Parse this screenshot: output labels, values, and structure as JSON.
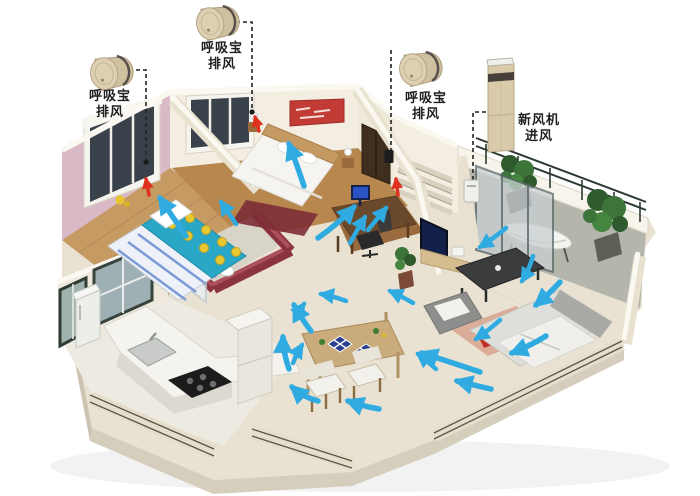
{
  "diagram": {
    "type": "3d-floorplan-ventilation",
    "background": "#ffffff"
  },
  "labels": {
    "exhaust_1": {
      "line1": "呼吸宝",
      "line2": "排风"
    },
    "exhaust_2": {
      "line1": "呼吸宝",
      "line2": "排风"
    },
    "exhaust_3": {
      "line1": "呼吸宝",
      "line2": "排风"
    },
    "intake": {
      "line1": "新风机",
      "line2": "进风"
    }
  },
  "devices": [
    {
      "id": "exhaust_1",
      "icon": "exhaust-fan-cylinder-icon"
    },
    {
      "id": "exhaust_2",
      "icon": "exhaust-fan-cylinder-icon"
    },
    {
      "id": "exhaust_3",
      "icon": "exhaust-fan-cylinder-icon"
    },
    {
      "id": "intake",
      "icon": "fresh-air-tower-icon"
    }
  ],
  "airflow": {
    "blue_arrow_count": 22,
    "red_arrow_count": 3,
    "blue_arrow_color": "#2fabe1",
    "red_arrow_color": "#e0301e"
  },
  "colors": {
    "pink_wall": "#d9b9c6",
    "maroon_wall": "#8c3340",
    "cream_wall": "#f3eee1",
    "slab": "#e9e2d2",
    "wood_floor": "#b8874e",
    "kid_bed_duvet": "#2aa7c7",
    "device_body": "#d5c6a5",
    "leader_line": "#222222"
  }
}
